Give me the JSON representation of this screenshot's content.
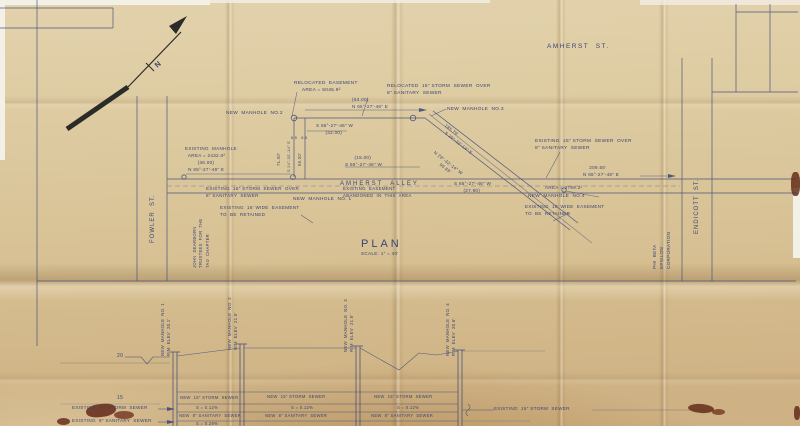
{
  "document": {
    "kind": "scanned engineering drawing",
    "view_title": "PLAN",
    "view_scale": "SCALE: 1″ = 40′"
  },
  "palette": {
    "ink": "#3a4575",
    "arrow_black": "#2b2b28",
    "stain": "#5e2414",
    "paper_light": "#e2d2ac",
    "paper_dark": "#cdb083"
  },
  "annotations": [
    {
      "id": "amherst-st-label",
      "text": "AMHERST  ST.",
      "x": 547,
      "y": 42,
      "fs": 6.5,
      "ls": 1.5
    },
    {
      "id": "fowler-st-label",
      "text": "FOWLER  ST.",
      "x": 149,
      "y": 243,
      "fs": 6,
      "rot": -90,
      "ls": 1
    },
    {
      "id": "endicott-st-label",
      "text": "ENDICOTT  ST.",
      "x": 693,
      "y": 234,
      "fs": 6,
      "rot": -90,
      "ls": 1
    },
    {
      "id": "phi-beta-epsilon-label",
      "text": "PHI  BETA\nEPSILON\nCORPORATION",
      "x": 652,
      "y": 269,
      "fs": 4.6,
      "rot": -90
    },
    {
      "id": "trustees-label",
      "text": "JOHN  DEARBORN\nTRUSTEES  FOR  THE\nTAU  CHAPTER",
      "x": 192,
      "y": 268,
      "fs": 4.2,
      "rot": -90
    },
    {
      "id": "north-label",
      "text": "N",
      "x": 152,
      "y": 62,
      "fs": 7.5,
      "rot": -42,
      "b": 1
    },
    {
      "id": "relocated-easement-label",
      "text": "RELOCATED  EASEMENT\n     AREA = 5045.9²",
      "x": 294,
      "y": 80,
      "fs": 4.8
    },
    {
      "id": "relocated-storm-label",
      "text": "RELOCATED  15″ STORM  SEWER  OVER\n8″ SANITARY  SEWER",
      "x": 387,
      "y": 83,
      "fs": 4.8
    },
    {
      "id": "dim-63",
      "text": "(63.00)\nN 65°-27′-46″ E",
      "x": 352,
      "y": 97,
      "fs": 4.6
    },
    {
      "id": "new-manhole-2-label",
      "text": "NEW  MANHOLE  NO.2",
      "x": 226,
      "y": 110,
      "fs": 4.8
    },
    {
      "id": "new-manhole-3-label",
      "text": "NEW  MANHOLE  NO.3",
      "x": 447,
      "y": 106,
      "fs": 4.8
    },
    {
      "id": "dim-32",
      "text": "S 65°-27′-46″ W\n      (32.00)",
      "x": 316,
      "y": 123,
      "fs": 4.6
    },
    {
      "id": "existing-manhole-label",
      "text": "EXISTING  MANHOLE\n  AREA = 2432.0²\n        (36.00)\n  N 65°-27′-46″ E",
      "x": 185,
      "y": 146,
      "fs": 4.6
    },
    {
      "id": "dim-85",
      "text": "8.5   8.5",
      "x": 291,
      "y": 136,
      "fs": 3.8
    },
    {
      "id": "dim-71",
      "text": "71.00′",
      "x": 276,
      "y": 166,
      "fs": 4.2,
      "rot": -90
    },
    {
      "id": "dim-s24",
      "text": "S 24°-32′-14″ E",
      "x": 286,
      "y": 172,
      "fs": 3.9,
      "rot": -90
    },
    {
      "id": "dim-55",
      "text": "55.00′",
      "x": 297,
      "y": 166,
      "fs": 4.2,
      "rot": -90
    },
    {
      "id": "diag-bearing-upper",
      "text": "185.79′\n   S 29°-32′-14″ E",
      "x": 447,
      "y": 123,
      "fs": 4.3,
      "rot": 38
    },
    {
      "id": "diag-bearing-lower",
      "text": "N 29°-32′-14″ W\n        99.89′",
      "x": 436,
      "y": 150,
      "fs": 4.3,
      "rot": 38
    },
    {
      "id": "existing-storm-right-label",
      "text": "EXISTING  15″ STORM  SEWER  OVER\n8″ SANITARY  SEWER",
      "x": 535,
      "y": 138,
      "fs": 4.8
    },
    {
      "id": "dim-209",
      "text": "    209.55′\nN 65°-27′-46″ E",
      "x": 583,
      "y": 165,
      "fs": 4.6
    },
    {
      "id": "dim-15",
      "text": "      (15.00)\nS 65°-27′-46″ W",
      "x": 345,
      "y": 155,
      "fs": 4.6
    },
    {
      "id": "dim-2790",
      "text": "S 65°-27′-46″ W\n      (27.90)",
      "x": 454,
      "y": 181,
      "fs": 4.6
    },
    {
      "id": "area-3799",
      "text": "AREA = 3799.2²",
      "x": 545,
      "y": 185,
      "fs": 4.6
    },
    {
      "id": "new-manhole-4-label",
      "text": "NEW  MANHOLE  NO.4",
      "x": 528,
      "y": 193,
      "fs": 4.8
    },
    {
      "id": "amherst-alley-label",
      "text": "AMHERST  ALLEY",
      "x": 340,
      "y": 180,
      "fs": 6,
      "ls": 2
    },
    {
      "id": "abandoned-easement-label",
      "text": "EXISTING  EASEMENT\nABANDONED  IN  THIS  AREA",
      "x": 343,
      "y": 186,
      "fs": 4.4
    },
    {
      "id": "existing-storm-left-label",
      "text": "EXISTING  15″ STORM  SEWER  OVER\n8″ SANITARY  SEWER",
      "x": 206,
      "y": 186,
      "fs": 4.6
    },
    {
      "id": "new-manhole-1-label",
      "text": "NEW  MANHOLE  NO. 1",
      "x": 293,
      "y": 196,
      "fs": 4.8
    },
    {
      "id": "easement-retained-left-label",
      "text": "EXISTING  16′ WIDE  EASEMENT\nTO  BE  RETAINED",
      "x": 220,
      "y": 205,
      "fs": 4.6
    },
    {
      "id": "easement-retained-right-label",
      "text": "EXISTING  16′ WIDE  EASEMENT\nTO  BE  RETAINED",
      "x": 525,
      "y": 204,
      "fs": 4.6
    },
    {
      "id": "plan-title",
      "text": "PLAN",
      "x": 361,
      "y": 236,
      "fs": 11,
      "ls": 3
    },
    {
      "id": "plan-scale",
      "text": "SCALE: 1″ = 40′",
      "x": 361,
      "y": 251,
      "fs": 4.6
    },
    {
      "id": "profile-mh1-label",
      "text": "NEW  MANHOLE  NO. 1\nRIM  ELEV  20.1′",
      "x": 160,
      "y": 356,
      "fs": 4.3,
      "rot": -90
    },
    {
      "id": "profile-mh2-label",
      "text": "NEW  MANHOLE  NO. 2\nRIM  ELEV  21.5′",
      "x": 227,
      "y": 350,
      "fs": 4.3,
      "rot": -90
    },
    {
      "id": "profile-mh3-label",
      "text": "NEW  MANHOLE  NO. 3\nRIM  ELEV  21.5′",
      "x": 343,
      "y": 352,
      "fs": 4.3,
      "rot": -90
    },
    {
      "id": "profile-mh4-label",
      "text": "NEW  MANHOLE  NO. 4\nRIM  ELEV  20.6′",
      "x": 445,
      "y": 356,
      "fs": 4.3,
      "rot": -90
    },
    {
      "id": "elev-20",
      "text": "20",
      "x": 117,
      "y": 353,
      "fs": 5
    },
    {
      "id": "elev-15",
      "text": "15",
      "x": 117,
      "y": 395,
      "fs": 5
    },
    {
      "id": "existing-12-storm-label",
      "text": "EXISTING  12″ STORM  SEWER",
      "x": 72,
      "y": 405,
      "fs": 4.6
    },
    {
      "id": "existing-8-san-left-label",
      "text": "EXISTING  8″ SANITARY  SEWER",
      "x": 72,
      "y": 418,
      "fs": 4.6
    },
    {
      "id": "seg1-storm-label",
      "text": "NEW  15″ STORM  SEWER",
      "x": 180,
      "y": 395,
      "fs": 4.2
    },
    {
      "id": "seg1-slope-storm",
      "text": "S = 0.12%",
      "x": 196,
      "y": 405,
      "fs": 4.2
    },
    {
      "id": "seg1-san-label",
      "text": "NEW  8″ SANITARY  SEWER",
      "x": 179,
      "y": 413,
      "fs": 4.2
    },
    {
      "id": "seg1-slope-san",
      "text": "S = 0.29%",
      "x": 196,
      "y": 421,
      "fs": 4.2
    },
    {
      "id": "seg2-storm-label",
      "text": "NEW  15″ STORM  SEWER",
      "x": 267,
      "y": 394,
      "fs": 4.2
    },
    {
      "id": "seg2-slope-storm",
      "text": "S = 0.12%",
      "x": 291,
      "y": 405,
      "fs": 4.2
    },
    {
      "id": "seg2-san-label",
      "text": "NEW  8″ SANITARY  SEWER",
      "x": 265,
      "y": 413,
      "fs": 4.2
    },
    {
      "id": "seg3-storm-label",
      "text": "NEW  15″ STORM  SEWER",
      "x": 374,
      "y": 394,
      "fs": 4.2
    },
    {
      "id": "seg3-slope-storm",
      "text": "S = 0.12%",
      "x": 397,
      "y": 405,
      "fs": 4.2
    },
    {
      "id": "seg3-san-label",
      "text": "NEW  8″ SANITARY  SEWER",
      "x": 371,
      "y": 413,
      "fs": 4.2
    },
    {
      "id": "existing-15-storm-right-label",
      "text": "EXISTING  15″ STORM  SEWER",
      "x": 494,
      "y": 406,
      "fs": 4.6
    }
  ]
}
